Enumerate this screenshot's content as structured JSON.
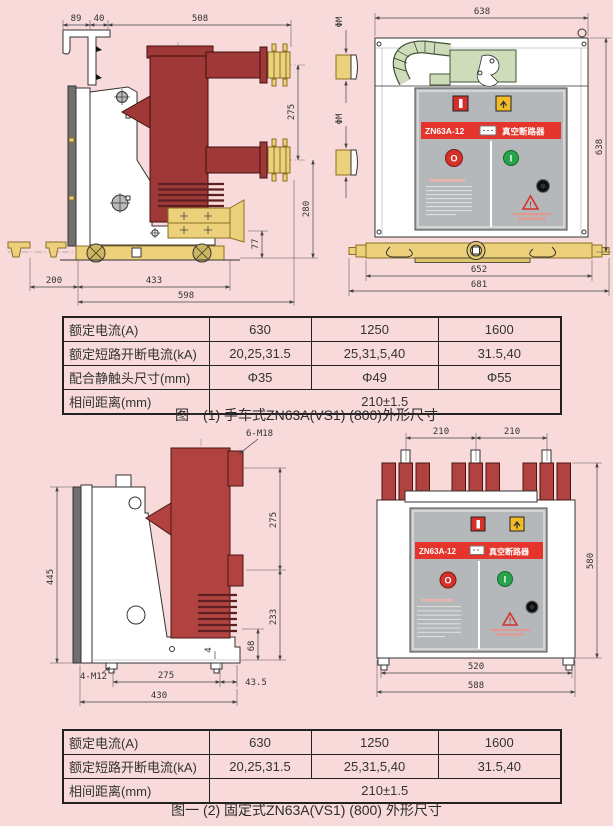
{
  "page": {
    "bg": "#f8dada"
  },
  "panel": {
    "model": "ZN63A-12",
    "name": "真空断路器",
    "open_btn": "O",
    "close_btn": "I",
    "warn": "!"
  },
  "fig1": {
    "caption": "图一(1) 手车式ZN63A(VS1) (800)外形尺寸",
    "side_dims": {
      "d89": "89",
      "d40": "40",
      "d508": "508",
      "d275": "275",
      "d280": "280",
      "d77": "77",
      "d200": "200",
      "d433": "433",
      "d598": "598"
    },
    "front_dims": {
      "top": "638",
      "right": "638",
      "inner": "652",
      "outer": "681",
      "phi_upper": "ΦM",
      "phi_lower": "ΦM"
    }
  },
  "fig2": {
    "caption": "图一 (2) 固定式ZN63A(VS1) (800) 外形尺寸",
    "side_dims": {
      "bolt_top": "6-M18",
      "d445": "445",
      "d275r": "275",
      "d233": "233",
      "d68": "68",
      "d4": "4",
      "bolt_bottom": "4-M12",
      "d275b": "275",
      "d435": "43.5",
      "d430": "430"
    },
    "front_dims": {
      "pitch1": "210",
      "pitch2": "210",
      "height": "580",
      "inner": "520",
      "outer": "588"
    }
  },
  "table1": {
    "rows": {
      "r0": {
        "label": "额定电流(A)",
        "c1": "630",
        "c2": "1250",
        "c3": "1600"
      },
      "r1": {
        "label": "额定短路开断电流(kA)",
        "c1": "20,25,31.5",
        "c2": "25,31,5,40",
        "c3": "31.5,40"
      },
      "r2": {
        "label": "配合静触头尺寸(mm)",
        "c1": "Φ35",
        "c2": "Φ49",
        "c3": "Φ55"
      },
      "r3": {
        "label": "相间距离(mm)",
        "merged": "210±1.5"
      }
    }
  },
  "table2": {
    "rows": {
      "r0": {
        "label": "额定电流(A)",
        "c1": "630",
        "c2": "1250",
        "c3": "1600"
      },
      "r1": {
        "label": "额定短路开断电流(kA)",
        "c1": "20,25,31.5",
        "c2": "25,31,5,40",
        "c3": "31.5,40"
      },
      "r2": {
        "label": "相间距离(mm)",
        "merged": "210±1.5"
      }
    }
  },
  "colors": {
    "background": "#f8dada",
    "banner_red": "#e5342b",
    "insulator_red_handcart": "#9e3937",
    "insulator_red_fixed": "#b04340",
    "hardware_yellow": "#ecd07c",
    "panel_gray": "#b5b8ba",
    "mech_green": "#cfdcba",
    "close_green": "#28a34b",
    "open_red": "#d5312a",
    "indicator_yellow": "#f2bc27"
  }
}
